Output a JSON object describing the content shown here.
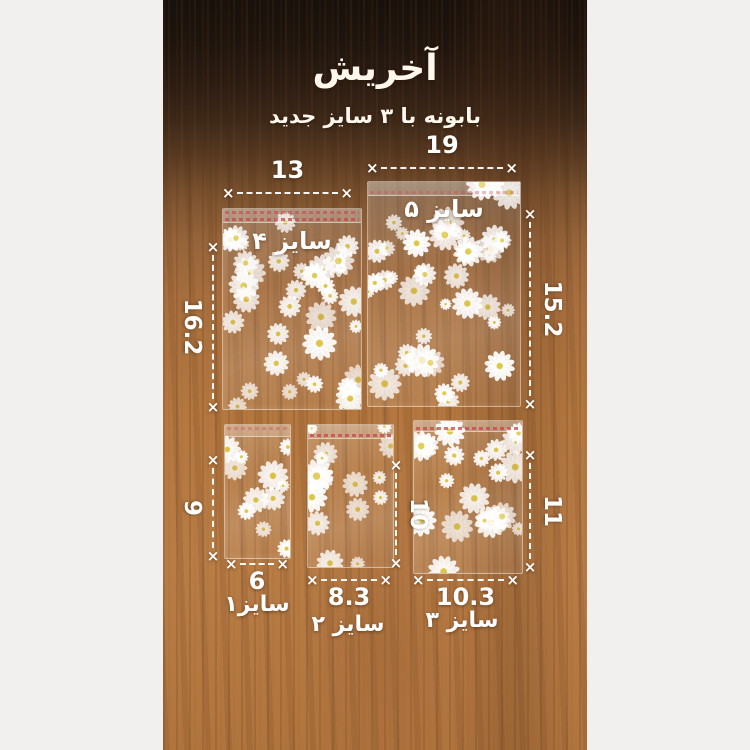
{
  "header": {
    "title": "آخریش",
    "subtitle": "بابونه با ۳ سایز جدید"
  },
  "bags": [
    {
      "name": "size-4",
      "label": "سایز ۴",
      "width_cm": "13",
      "height_cm": "16.2"
    },
    {
      "name": "size-5",
      "label": "سایز ۵",
      "width_cm": "19",
      "height_cm": "15.2"
    },
    {
      "name": "size-1",
      "label": "سایز۱",
      "width_cm": "6",
      "height_cm": "9"
    },
    {
      "name": "size-2",
      "label": "سایز ۲",
      "width_cm": "8.3",
      "height_cm": "10"
    },
    {
      "name": "size-3",
      "label": "سایز ۳",
      "width_cm": "10.3",
      "height_cm": "11"
    }
  ],
  "marker_glyph": "×",
  "colors": {
    "measurement_text": "#ffffff",
    "wood_light": "#b5783f",
    "wood_dark": "#1d130d",
    "daisy_petal": "#ffffff",
    "daisy_center": "#dfca49",
    "flap_print_red": "#c84550",
    "side_bar": "#f1f0ee"
  }
}
